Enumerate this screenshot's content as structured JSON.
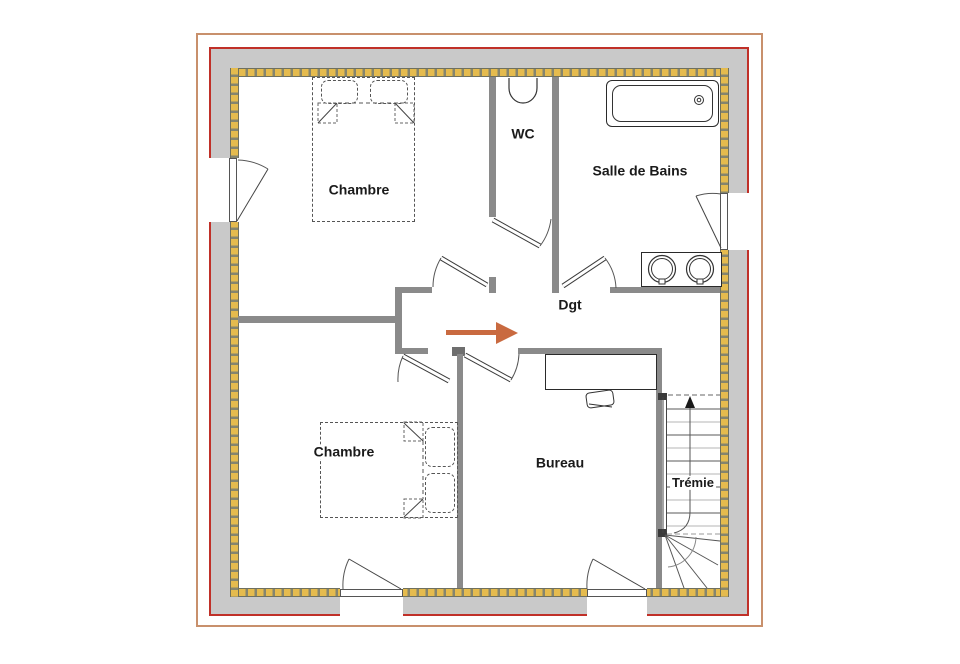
{
  "plan": {
    "rooms": [
      {
        "id": "chambre-1",
        "label": "Chambre"
      },
      {
        "id": "wc",
        "label": "WC"
      },
      {
        "id": "salle-de-bains",
        "label": "Salle de Bains"
      },
      {
        "id": "degagement",
        "label": "Dgt"
      },
      {
        "id": "chambre-2",
        "label": "Chambre"
      },
      {
        "id": "bureau",
        "label": "Bureau"
      },
      {
        "id": "tremie",
        "label": "Trémie"
      }
    ],
    "annotations": {
      "entry_arrow_direction": "right",
      "stairs_arrow_direction": "up"
    },
    "colors": {
      "outer_border": "#c8906c",
      "red_border": "#c03028",
      "exterior_wall_fill": "#c9c9c9",
      "hatch_yellow": "#e5bb4e",
      "hatch_gap": "#85856e",
      "interior_wall": "#8a8a8a",
      "arrow_accent": "#c96a40",
      "label_text": "#1a1a1a"
    }
  }
}
